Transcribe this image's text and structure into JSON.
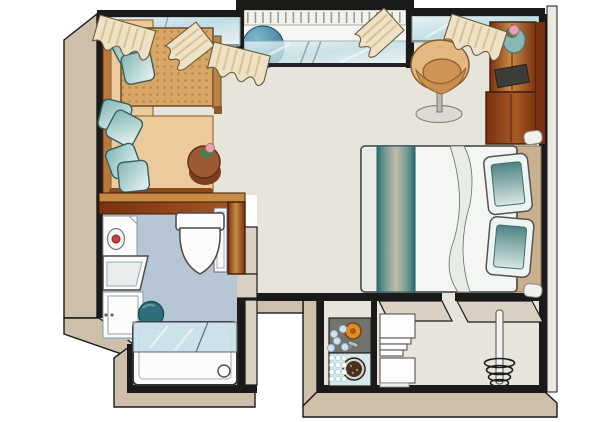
{
  "labels": {
    "scene": "Isometric floor plan of a studio apartment",
    "living_area": "Living area with corner sofa, cushions, large table and round side table with flower",
    "balcony": "Recessed balcony with railing, glazing and round blue object",
    "bedroom": "Sleeping area with double bed, striped runner, pillows, tub chair and wooden wardrobe",
    "bathroom": "Bathroom with vanity, mirror, sink, cabinet, toilet, stool and bathtub with glass screen",
    "kitchen": "Kitchenette niche with cooktop, sink and white shelf units",
    "entry": "Entry area with free-standing coat stand",
    "windows": "Window bands with curtains along the top wall"
  },
  "objects": {
    "living_area": [
      "corner-sofa",
      "sofa-cushions",
      "woven-table",
      "round-side-table",
      "flower-pot"
    ],
    "balcony": [
      "railing",
      "blue-sphere",
      "window-band",
      "curtains"
    ],
    "bedroom": [
      "tub-chair",
      "chair-pedestal",
      "wardrobe",
      "plant-pot",
      "dark-tray",
      "double-bed",
      "bed-runner",
      "bed-pillows",
      "bedside-posts"
    ],
    "bathroom": [
      "wood-wall",
      "bathroom-door",
      "vanity-mirror",
      "wash-basin",
      "base-cabinet",
      "toilet",
      "teal-stool",
      "bathtub",
      "glass-screen",
      "drain"
    ],
    "kitchen": [
      "cooktop-counter",
      "orange-burner",
      "blue-dots",
      "pot",
      "shelf-tower",
      "shelf-cabinet"
    ],
    "entry": [
      "coat-stand-pole",
      "coat-stand-coils"
    ]
  },
  "colors": {
    "wall_line": "#1a1a1a",
    "exterior_band": "#cdbfa9",
    "exterior_band_light": "#ece7df",
    "wall_top": "#dad0c1",
    "floor_main": "#e6e4db",
    "floor_bath": "#b6c6d4",
    "glass_light": "#e9f4f6",
    "glass_mid": "#c0dde4",
    "curtain": "#eee2c6",
    "curtain_stripe": "#d8c295",
    "railing": "#f2f1ec",
    "balcony_floor": "#f6f5f1",
    "sofa_seat": "#edca9c",
    "sofa_edge": "#8a4a1e",
    "table_tan": "#d8a667",
    "table_dot": "#bf8b47",
    "pillow_teal": "#7fb5b5",
    "pillow_light": "#eef6f5",
    "pillow_line": "#35605f",
    "side_table": "#9c5a33",
    "side_table_dark": "#7b3f20",
    "plant_green": "#4e7d52",
    "flower_pink": "#e9a3ac",
    "chair_tan": "#e3b881",
    "chair_seat": "#cf9454",
    "chair_base": "#dadad6",
    "sphere_light": "#7fb9cc",
    "sphere_dark": "#2e6f8e",
    "wood_dark": "#7a3010",
    "wood_mid": "#a85a24",
    "wood_light": "#c98a45",
    "bed_white": "#f4f6f3",
    "runner_teal": "#2f6b6c",
    "runner_mid": "#6e9894",
    "runner_center": "#c2baa8",
    "bed_pillow_teal": "#4e8486",
    "bed_pillow_light": "#d8e6e0",
    "headboard": "#c9b08e",
    "fixture_white": "#fbfbfa",
    "fixture_line": "#4a4a4a",
    "red_accent": "#c14040",
    "stool_teal": "#2e6f7d",
    "tub_glass": "#c9dfe9",
    "counter_gray": "#73736d",
    "counter_glass": "#d6e8ea",
    "burner_orange": "#e08a28",
    "pot_dark": "#43301f",
    "dot_blue": "#cfe2ee",
    "shelf_white": "#fdfdfc",
    "door_white": "#f8f8f6"
  }
}
